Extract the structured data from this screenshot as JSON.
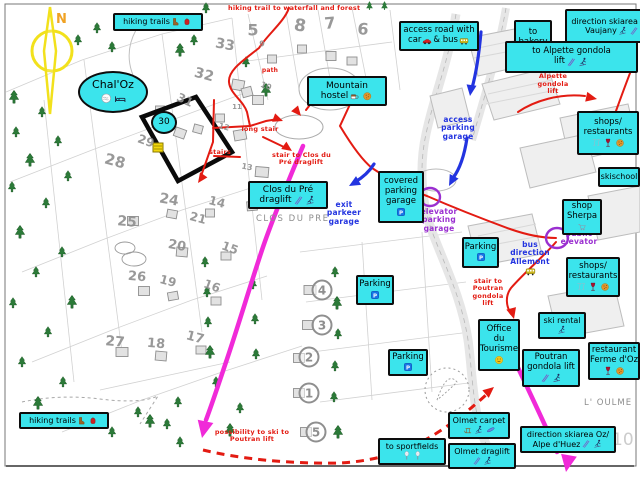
{
  "colors": {
    "label_bg": "#3be4ec",
    "red": "#e31b12",
    "blue": "#2334e0",
    "purple": "#9a2fd0",
    "magenta": "#f02ad8",
    "tree_green": "#2b7a38",
    "map_gray": "#8f8f8f",
    "compass_yellow": "#f2e11c",
    "compass_n": "#f0a224"
  },
  "compass": {
    "label": "N"
  },
  "labels": [
    {
      "id": "label-hiking-trails-top",
      "x": 113,
      "y": 13,
      "w": 90,
      "h": 18,
      "fs": 8,
      "lines": [
        "hiking trails {boot} {backpack}"
      ]
    },
    {
      "id": "label-access-road",
      "x": 399,
      "y": 21,
      "w": 80,
      "h": 30,
      "fs": 8.5,
      "lines": [
        "access road with",
        "car {car} & bus {bus}"
      ]
    },
    {
      "id": "label-to-bakery",
      "x": 514,
      "y": 20,
      "w": 38,
      "h": 45,
      "fs": 8.5,
      "lines": [
        "to",
        "bakery",
        "{croissant} {baguette}"
      ]
    },
    {
      "id": "label-direction-skiarea-vaujany",
      "x": 565,
      "y": 9,
      "w": 95,
      "h": 34,
      "fs": 8,
      "lines": [
        "direction skiarea Oz/",
        "Vaujany {skier} {ski}"
      ]
    },
    {
      "id": "label-to-alpette-gondola-lift",
      "x": 505,
      "y": 41,
      "w": 133,
      "h": 32,
      "fs": 8.5,
      "lines": [
        "to Alpette gondola",
        "lift {ski} {skier}"
      ]
    },
    {
      "id": "label-mountain-hostel",
      "x": 307,
      "y": 76,
      "w": 80,
      "h": 30,
      "fs": 9,
      "lines": [
        "Mountain",
        "hostel {cup} {cookie}"
      ]
    },
    {
      "id": "label-shops-restaurants-1",
      "x": 577,
      "y": 111,
      "w": 62,
      "h": 44,
      "fs": 8.5,
      "lines": [
        "shops/",
        "restaurants",
        "{glasses} {wine} {cookie}"
      ]
    },
    {
      "id": "label-skischool",
      "x": 598,
      "y": 167,
      "w": 42,
      "h": 20,
      "fs": 8,
      "lines": [
        "skischool"
      ]
    },
    {
      "id": "label-shop-sherpa",
      "x": 562,
      "y": 199,
      "w": 40,
      "h": 36,
      "fs": 8.5,
      "lines": [
        "shop",
        "Sherpa",
        "{cart}"
      ]
    },
    {
      "id": "label-shops-restaurants-2",
      "x": 566,
      "y": 257,
      "w": 54,
      "h": 40,
      "fs": 8.5,
      "lines": [
        "shops/",
        "restaurants",
        "{glasses} {wine} {cookie}"
      ]
    },
    {
      "id": "label-clos-du-pre-draglift",
      "x": 248,
      "y": 181,
      "w": 80,
      "h": 28,
      "fs": 9,
      "lines": [
        "Clos du Pré",
        "draglift {ski} {skier}"
      ]
    },
    {
      "id": "label-covered-parking-garage",
      "x": 378,
      "y": 171,
      "w": 46,
      "h": 52,
      "fs": 8.5,
      "lines": [
        "covered",
        "parking",
        "garage",
        "{parking}"
      ]
    },
    {
      "id": "label-parking-1",
      "x": 462,
      "y": 237,
      "w": 37,
      "h": 31,
      "fs": 8.5,
      "lines": [
        "Parking",
        "{parking}"
      ]
    },
    {
      "id": "label-parking-2",
      "x": 356,
      "y": 275,
      "w": 38,
      "h": 30,
      "fs": 8.5,
      "lines": [
        "Parking",
        "{parking}"
      ]
    },
    {
      "id": "label-parking-3",
      "x": 388,
      "y": 349,
      "w": 40,
      "h": 27,
      "fs": 8.5,
      "lines": [
        "Parking",
        "{parking}"
      ]
    },
    {
      "id": "label-office-du-tourisme",
      "x": 478,
      "y": 319,
      "w": 42,
      "h": 52,
      "fs": 8.5,
      "lines": [
        "Office",
        "du",
        "Tourisme",
        "{info}"
      ]
    },
    {
      "id": "label-ski-rental",
      "x": 538,
      "y": 312,
      "w": 48,
      "h": 27,
      "fs": 8,
      "lines": [
        "ski rental",
        "{skier}"
      ]
    },
    {
      "id": "label-poutran-gondola-lift",
      "x": 522,
      "y": 349,
      "w": 58,
      "h": 38,
      "fs": 8.5,
      "lines": [
        "Poutran",
        "gondola lift",
        "{ski} {skier}"
      ]
    },
    {
      "id": "label-restaurant-ferme-doz",
      "x": 588,
      "y": 342,
      "w": 52,
      "h": 38,
      "fs": 8.5,
      "lines": [
        "restaurant",
        "Ferme d'Oz",
        "{wine} {cookie}"
      ]
    },
    {
      "id": "label-olmet-carpet",
      "x": 448,
      "y": 412,
      "w": 62,
      "h": 27,
      "fs": 8,
      "lines": [
        "Olmet carpet",
        "{sled} {skier} {board}"
      ]
    },
    {
      "id": "label-olmet-draglift",
      "x": 448,
      "y": 443,
      "w": 68,
      "h": 26,
      "fs": 8,
      "lines": [
        "Olmet draglift",
        "{ski} {skier}"
      ]
    },
    {
      "id": "label-to-sportfields",
      "x": 378,
      "y": 438,
      "w": 68,
      "h": 27,
      "fs": 8,
      "lines": [
        "to sportfields",
        "{racket} {racket}"
      ]
    },
    {
      "id": "label-direction-skiarea-oz-alpe-dhuez",
      "x": 520,
      "y": 426,
      "w": 96,
      "h": 27,
      "fs": 8,
      "lines": [
        "direction skiarea Oz/",
        "Alpe d'Huez {ski} {skier}"
      ]
    },
    {
      "id": "label-hiking-trails-bottom",
      "x": 19,
      "y": 412,
      "w": 90,
      "h": 17,
      "fs": 8,
      "lines": [
        "hiking trails {boot} {backpack}"
      ]
    },
    {
      "id": "label-chal-oz",
      "x": 78,
      "y": 71,
      "w": 70,
      "h": 42,
      "fs": 11,
      "shape": "oval",
      "lines": [
        "Chal'Oz",
        "{pool} {bed}"
      ]
    },
    {
      "id": "label-lot-30",
      "x": 151,
      "y": 111,
      "w": 26,
      "h": 23,
      "fs": 9,
      "shape": "oval",
      "lines": [
        "30"
      ]
    }
  ],
  "annotations": [
    {
      "id": "note-hiking-waterfall",
      "color": "red",
      "x": 228,
      "y": 0,
      "w": 150,
      "fs": 6.5,
      "lines": [
        "hiking trail to waterfall and forest {tree} {tree}"
      ]
    },
    {
      "id": "note-path",
      "color": "red",
      "x": 258,
      "y": 68,
      "w": 24,
      "fs": 6,
      "lines": [
        "path"
      ]
    },
    {
      "id": "note-long-stair",
      "color": "red",
      "x": 238,
      "y": 126,
      "w": 44,
      "fs": 6.5,
      "lines": [
        "long stair"
      ]
    },
    {
      "id": "note-stairs",
      "color": "red",
      "x": 206,
      "y": 149,
      "w": 28,
      "fs": 6.5,
      "lines": [
        "stairs"
      ]
    },
    {
      "id": "note-stair-clos-du-pre",
      "color": "red",
      "x": 272,
      "y": 152,
      "w": 58,
      "fs": 6.5,
      "lines": [
        "stair to Clos du",
        "Pré draglift"
      ]
    },
    {
      "id": "note-stair-alpette",
      "color": "red",
      "x": 536,
      "y": 66,
      "w": 34,
      "fs": 6.5,
      "lines": [
        "stair to",
        "Alpette",
        "gondola",
        "lift"
      ]
    },
    {
      "id": "note-stair-poutran",
      "color": "red",
      "x": 468,
      "y": 278,
      "w": 40,
      "fs": 6.5,
      "lines": [
        "stair to",
        "Poutran",
        "gondola",
        "lift"
      ]
    },
    {
      "id": "note-possibility-ski",
      "color": "red",
      "x": 210,
      "y": 429,
      "w": 84,
      "fs": 6.5,
      "lines": [
        "possibility to ski to",
        "Poutran lift"
      ]
    },
    {
      "id": "note-access-parking-garage",
      "color": "blue",
      "x": 436,
      "y": 116,
      "w": 44,
      "fs": 7.5,
      "lines": [
        "access",
        "parking",
        "garage"
      ]
    },
    {
      "id": "note-exit-parkeer-garage",
      "color": "blue",
      "x": 322,
      "y": 201,
      "w": 44,
      "fs": 7.5,
      "lines": [
        "exit",
        "parkeer",
        "garage"
      ]
    },
    {
      "id": "note-bus-direction-allemont",
      "color": "blue",
      "x": 502,
      "y": 241,
      "w": 56,
      "fs": 7.5,
      "lines": [
        "bus",
        "direction",
        "Allemont",
        "{bus}"
      ]
    },
    {
      "id": "note-elevator-parking-garage",
      "color": "purple",
      "x": 416,
      "y": 208,
      "w": 46,
      "fs": 7.5,
      "lines": [
        "elevator",
        "parking",
        "garage"
      ]
    },
    {
      "id": "note-public-elevator",
      "color": "purple",
      "x": 556,
      "y": 230,
      "w": 46,
      "fs": 7.5,
      "lines": [
        "public",
        "elevator"
      ]
    }
  ],
  "map_texts": [
    {
      "id": "maptext-clos-du-pre",
      "text": "CLOS DU PRE",
      "x": 256,
      "y": 214,
      "fs": 8.5,
      "ls": 1.5,
      "color": "#8d8d8d"
    },
    {
      "id": "maptext-l-oulme",
      "text": "L' OULME",
      "x": 584,
      "y": 398,
      "fs": 8.5,
      "ls": 1,
      "color": "#8d8d8d"
    },
    {
      "id": "maptext-watermark-10",
      "text": "10",
      "x": 612,
      "y": 430,
      "fs": 17,
      "ls": 0,
      "color": "#cccccc"
    }
  ],
  "lot_numbers": [
    [
      "5",
      253,
      30,
      16,
      0
    ],
    [
      "8",
      300,
      26,
      17,
      10
    ],
    [
      "7",
      330,
      23,
      16,
      -5
    ],
    [
      "6",
      363,
      29,
      16,
      5
    ],
    [
      "33",
      225,
      45,
      14,
      10
    ],
    [
      "32",
      204,
      75,
      14,
      15
    ],
    [
      "31",
      185,
      100,
      12,
      25
    ],
    [
      "29",
      146,
      141,
      12,
      20
    ],
    [
      "28",
      115,
      161,
      15,
      15
    ],
    [
      "25",
      127,
      222,
      14,
      5
    ],
    [
      "24",
      169,
      200,
      14,
      10
    ],
    [
      "14",
      217,
      202,
      12,
      15
    ],
    [
      "21",
      198,
      218,
      12,
      15
    ],
    [
      "20",
      177,
      246,
      13,
      10
    ],
    [
      "15",
      230,
      248,
      12,
      20
    ],
    [
      "26",
      137,
      277,
      13,
      5
    ],
    [
      "19",
      168,
      281,
      12,
      15
    ],
    [
      "16",
      212,
      286,
      12,
      20
    ],
    [
      "27",
      115,
      342,
      14,
      5
    ],
    [
      "18",
      156,
      344,
      13,
      5
    ],
    [
      "17",
      195,
      338,
      13,
      15
    ],
    [
      "9",
      262,
      44,
      8,
      0
    ],
    [
      "10",
      266,
      86,
      8,
      20
    ],
    [
      "11",
      237,
      107,
      7,
      0
    ],
    [
      "12",
      224,
      127,
      8,
      15
    ],
    [
      "13",
      247,
      167,
      8,
      10
    ]
  ],
  "circled_numbers": [
    [
      "4",
      322,
      290
    ],
    [
      "3",
      322,
      325
    ],
    [
      "2",
      309,
      357
    ],
    [
      "1",
      309,
      393
    ],
    [
      "5",
      316,
      432
    ]
  ],
  "trees": [
    [
      14,
      97
    ],
    [
      42,
      112
    ],
    [
      16,
      132
    ],
    [
      58,
      141
    ],
    [
      30,
      160
    ],
    [
      12,
      187
    ],
    [
      68,
      176
    ],
    [
      46,
      203
    ],
    [
      20,
      232
    ],
    [
      62,
      252
    ],
    [
      36,
      272
    ],
    [
      13,
      303
    ],
    [
      72,
      302
    ],
    [
      48,
      332
    ],
    [
      22,
      362
    ],
    [
      63,
      382
    ],
    [
      38,
      403
    ],
    [
      90,
      418
    ],
    [
      112,
      432
    ],
    [
      138,
      412
    ],
    [
      150,
      421
    ],
    [
      167,
      424
    ],
    [
      178,
      402
    ],
    [
      180,
      442
    ],
    [
      230,
      430
    ],
    [
      78,
      40
    ],
    [
      97,
      28
    ],
    [
      112,
      47
    ],
    [
      180,
      50
    ],
    [
      194,
      40
    ],
    [
      206,
      8
    ],
    [
      246,
      62
    ],
    [
      266,
      90
    ],
    [
      205,
      262
    ],
    [
      207,
      292
    ],
    [
      208,
      322
    ],
    [
      210,
      352
    ],
    [
      216,
      382
    ],
    [
      240,
      408
    ],
    [
      335,
      272
    ],
    [
      337,
      303
    ],
    [
      338,
      334
    ],
    [
      335,
      366
    ],
    [
      334,
      397
    ],
    [
      338,
      432
    ],
    [
      253,
      284
    ],
    [
      255,
      319
    ],
    [
      256,
      354
    ]
  ],
  "buildings": [
    [
      238,
      85,
      12,
      10,
      10
    ],
    [
      258,
      100,
      11,
      9,
      0
    ],
    [
      240,
      135,
      12,
      10,
      -10
    ],
    [
      220,
      118,
      9,
      8,
      0
    ],
    [
      198,
      129,
      9,
      8,
      15
    ],
    [
      262,
      172,
      13,
      10,
      5
    ],
    [
      288,
      196,
      12,
      10,
      0
    ],
    [
      252,
      206,
      10,
      9,
      -5
    ],
    [
      133,
      221,
      11,
      9,
      0
    ],
    [
      172,
      214,
      10,
      8,
      10
    ],
    [
      210,
      213,
      9,
      8,
      0
    ],
    [
      182,
      252,
      11,
      9,
      5
    ],
    [
      226,
      256,
      10,
      8,
      0
    ],
    [
      144,
      291,
      11,
      9,
      0
    ],
    [
      173,
      296,
      10,
      8,
      -10
    ],
    [
      216,
      301,
      10,
      8,
      0
    ],
    [
      122,
      352,
      12,
      9,
      0
    ],
    [
      161,
      356,
      11,
      9,
      5
    ],
    [
      201,
      350,
      10,
      8,
      0
    ],
    [
      310,
      290,
      12,
      9,
      0
    ],
    [
      308,
      325,
      11,
      9,
      0
    ],
    [
      299,
      358,
      11,
      9,
      0
    ],
    [
      299,
      393,
      11,
      9,
      0
    ],
    [
      306,
      432,
      11,
      9,
      0
    ],
    [
      331,
      56,
      10,
      9,
      0
    ],
    [
      352,
      61,
      10,
      8,
      0
    ],
    [
      302,
      49,
      9,
      8,
      0
    ],
    [
      272,
      59,
      9,
      8,
      0
    ],
    [
      247,
      92,
      10,
      9,
      -15
    ],
    [
      180,
      133,
      11,
      9,
      20
    ],
    [
      160,
      110,
      9,
      8,
      0
    ]
  ]
}
